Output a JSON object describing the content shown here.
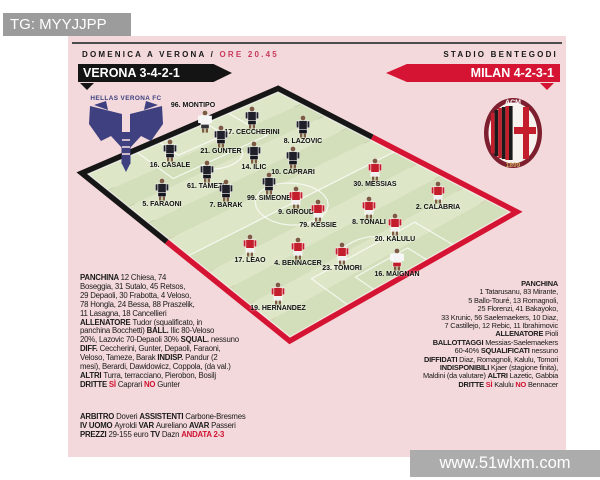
{
  "overlay": {
    "tag": "TG: MYYJJPP",
    "site": "www.51wlxm.com"
  },
  "header": {
    "kickoff_prefix": "DOMENICA A VERONA / ",
    "kickoff_time": "ORE 20.45",
    "stadium": "STADIO BENTEGODI"
  },
  "teams": {
    "home": {
      "banner": "VERONA 3-4-2-1",
      "crest_title": "HELLAS VERONA FC"
    },
    "away": {
      "banner": "MILAN 4-2-3-1",
      "crest_top": "ACM",
      "crest_year": "1899"
    }
  },
  "colors": {
    "sheet_pink": "#f3d9db",
    "banner_black": "#141414",
    "banner_red": "#d41432",
    "time_red": "#c83b5e",
    "accent_red": "#cf1230",
    "crest_navy": "#3e4080",
    "pitch": {
      "stripe_light": "#dde7c8",
      "stripe_dark": "#d2dfba",
      "line": "rgba(255,255,255,0.75)",
      "border_home": "#161616",
      "border_away": "#d41432"
    },
    "kits": {
      "head": "#7c5b42",
      "verona": {
        "shirt": "#20202b",
        "shorts": "#15151d"
      },
      "milan": {
        "shirt": "#c41e2c",
        "shorts": "#f0f0f0"
      },
      "verona_gk": {
        "shirt": "#f5f5f5",
        "shorts": "#33333a"
      },
      "milan_gk": {
        "shirt": "#f5f5f5",
        "shorts": "#c41e2c"
      }
    }
  },
  "players": [
    {
      "label": "96. MONTIPO",
      "team": "verona_gk",
      "x": 137,
      "y": 86,
      "label_pos": "above",
      "dx": -12
    },
    {
      "label": "17. CECCHERINI",
      "team": "verona",
      "x": 184,
      "y": 81
    },
    {
      "label": "8. LAZOVIC",
      "team": "verona",
      "x": 235,
      "y": 90
    },
    {
      "label": "21. GUNTER",
      "team": "verona",
      "x": 153,
      "y": 100
    },
    {
      "label": "14. ILIC",
      "team": "verona",
      "x": 186,
      "y": 116
    },
    {
      "label": "10. CAPRARI",
      "team": "verona",
      "x": 225,
      "y": 121
    },
    {
      "label": "16. CASALE",
      "team": "verona",
      "x": 102,
      "y": 114
    },
    {
      "label": "61. TAMEZE",
      "team": "verona",
      "x": 139,
      "y": 135
    },
    {
      "label": "99. SIMEONE",
      "team": "verona",
      "x": 201,
      "y": 147
    },
    {
      "label": "5. FARAONI",
      "team": "verona",
      "x": 94,
      "y": 153
    },
    {
      "label": "7. BARAK",
      "team": "verona",
      "x": 158,
      "y": 154
    },
    {
      "label": "30. MESSIAS",
      "team": "milan",
      "x": 307,
      "y": 133
    },
    {
      "label": "2. CALABRIA",
      "team": "milan",
      "x": 370,
      "y": 156
    },
    {
      "label": "9. GIROUD",
      "team": "milan",
      "x": 228,
      "y": 161
    },
    {
      "label": "79. KESSIE",
      "team": "milan",
      "x": 250,
      "y": 174
    },
    {
      "label": "8. TONALI",
      "team": "milan",
      "x": 301,
      "y": 171
    },
    {
      "label": "20. KALULU",
      "team": "milan",
      "x": 327,
      "y": 188
    },
    {
      "label": "17. LEAO",
      "team": "milan",
      "x": 182,
      "y": 209
    },
    {
      "label": "4. BENNACER",
      "team": "milan",
      "x": 230,
      "y": 212
    },
    {
      "label": "23. TOMORI",
      "team": "milan",
      "x": 274,
      "y": 217
    },
    {
      "label": "16. MAIGNAN",
      "team": "milan_gk",
      "x": 329,
      "y": 223
    },
    {
      "label": "19. HERNANDEZ",
      "team": "milan",
      "x": 210,
      "y": 257
    }
  ],
  "panels": {
    "verona": [
      [
        {
          "t": "PANCHINA ",
          "s": "b"
        },
        {
          "t": "12 Chiesa, 74"
        }
      ],
      [
        {
          "t": "Boseggia, 31 Sutalo, 45 Retsos,"
        }
      ],
      [
        {
          "t": "29 Depaoli, 30 Frabotta, 4 Veloso,"
        }
      ],
      [
        {
          "t": "78 Hongla, 24 Bessa, 88 Praszelik,"
        }
      ],
      [
        {
          "t": "11 Lasagna, 18 Cancellieri"
        }
      ],
      [
        {
          "t": "ALLENATORE ",
          "s": "b"
        },
        {
          "t": "Tudor (squalificato, in"
        }
      ],
      [
        {
          "t": "panchina Bocchetti) "
        },
        {
          "t": "BALL. ",
          "s": "b"
        },
        {
          "t": "Ilic 80-Veloso"
        }
      ],
      [
        {
          "t": "20%, Lazovic 70-Depaoli 30% "
        },
        {
          "t": "SQUAL. ",
          "s": "b"
        },
        {
          "t": "nessuno"
        }
      ],
      [
        {
          "t": "DIFF. ",
          "s": "b"
        },
        {
          "t": "Ceccherini, Gunter, Depaoli, Faraoni,"
        }
      ],
      [
        {
          "t": "Veloso, Tameze, Barak "
        },
        {
          "t": "INDISP. ",
          "s": "b"
        },
        {
          "t": "Pandur (2"
        }
      ],
      [
        {
          "t": "mesi), Berardi, Dawidowicz, Coppola, (da val.)"
        }
      ],
      [
        {
          "t": "ALTRI ",
          "s": "b"
        },
        {
          "t": "Turra, terracciano, Pierobon, Bosilj"
        }
      ],
      [
        {
          "t": "DRITTE ",
          "s": "b"
        },
        {
          "t": "SÌ ",
          "s": "r"
        },
        {
          "t": "Caprari "
        },
        {
          "t": "NO ",
          "s": "r"
        },
        {
          "t": "Gunter"
        }
      ]
    ],
    "milan": [
      [
        {
          "t": "PANCHINA",
          "s": "b"
        }
      ],
      [
        {
          "t": "1 Tatarusanu, 83 Mirante,"
        }
      ],
      [
        {
          "t": "5 Ballo-Touré, 13 Romagnoli,"
        }
      ],
      [
        {
          "t": "25 Florenzi, 41 Bakayoko,"
        }
      ],
      [
        {
          "t": "33 Krunic, 56 Saelemaekers, 10 Diaz,"
        }
      ],
      [
        {
          "t": "7 Castillejo, 12 Rebic, 11 Ibrahimovic"
        }
      ],
      [
        {
          "t": "ALLENATORE ",
          "s": "b"
        },
        {
          "t": "Pioli"
        }
      ],
      [
        {
          "t": "BALLOTTAGGI ",
          "s": "b"
        },
        {
          "t": "Messias-Saelemaekers"
        }
      ],
      [
        {
          "t": "60-40% "
        },
        {
          "t": "SQUALIFICATI ",
          "s": "b"
        },
        {
          "t": "nessuno"
        }
      ],
      [
        {
          "t": "DIFFIDATI ",
          "s": "b"
        },
        {
          "t": "Diaz, Romagnoli, Kalulu, Tomori"
        }
      ],
      [
        {
          "t": "INDISPONIBILI ",
          "s": "b"
        },
        {
          "t": "Kjaer (stagione finita),"
        }
      ],
      [
        {
          "t": "Maldini (da valutare) "
        },
        {
          "t": "ALTRI ",
          "s": "b"
        },
        {
          "t": "Lazetic, Gabbia"
        }
      ],
      [
        {
          "t": "DRITTE ",
          "s": "b"
        },
        {
          "t": "SÌ ",
          "s": "r"
        },
        {
          "t": "Kalulu "
        },
        {
          "t": "NO ",
          "s": "r"
        },
        {
          "t": "Bennacer"
        }
      ]
    ],
    "match_info": [
      [
        {
          "t": "ARBITRO ",
          "s": "b"
        },
        {
          "t": "Doveri "
        },
        {
          "t": "ASSISTENTI ",
          "s": "b"
        },
        {
          "t": "Carbone-Bresmes"
        }
      ],
      [
        {
          "t": "IV UOMO ",
          "s": "b"
        },
        {
          "t": "Ayroldi "
        },
        {
          "t": "VAR ",
          "s": "b"
        },
        {
          "t": "Aureliano "
        },
        {
          "t": "AVAR ",
          "s": "b"
        },
        {
          "t": "Passeri"
        }
      ],
      [
        {
          "t": "PREZZI ",
          "s": "b"
        },
        {
          "t": "29-155 euro "
        },
        {
          "t": "TV ",
          "s": "b"
        },
        {
          "t": "Dazn "
        },
        {
          "t": "ANDATA 2-3",
          "s": "r"
        }
      ]
    ]
  }
}
